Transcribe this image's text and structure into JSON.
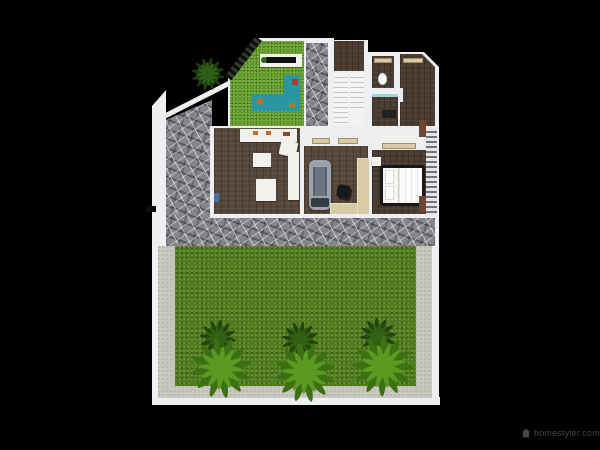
{
  "scene": {
    "description": "Top-down 3D render of a house floor plan with indoor garden, staircase, bedrooms, gym room and a large walled back lawn with palm trees"
  },
  "watermark": {
    "text": "homestyler.com",
    "icon": "homestyler-logo-icon"
  },
  "colors": {
    "wall": "#edeff0",
    "stone": "#85868b",
    "concrete": "#c7c7be",
    "lawn": "#4f7d1c",
    "garden_grass": "#5c9922",
    "floor_brown": "#57463a",
    "floor_dark": "#4a3b30",
    "sofa_teal": "#2a95a5",
    "cushion_orange": "#c96a28",
    "furniture_white": "#f1f1ee",
    "desk_beige": "#d8cba6",
    "treadmill_gray": "#99a2ad",
    "bed_frame": "#15171b",
    "wood": "#6e4632",
    "bath_glass": "#9fd5da",
    "palm_front_a": "#3c7013",
    "palm_front_b": "#5b9a20",
    "palm_back_a": "#24430f",
    "palm_back_b": "#336114",
    "tree_a": "#1e3d10",
    "tree_b": "#2f5f17",
    "watermark": "#454545"
  }
}
